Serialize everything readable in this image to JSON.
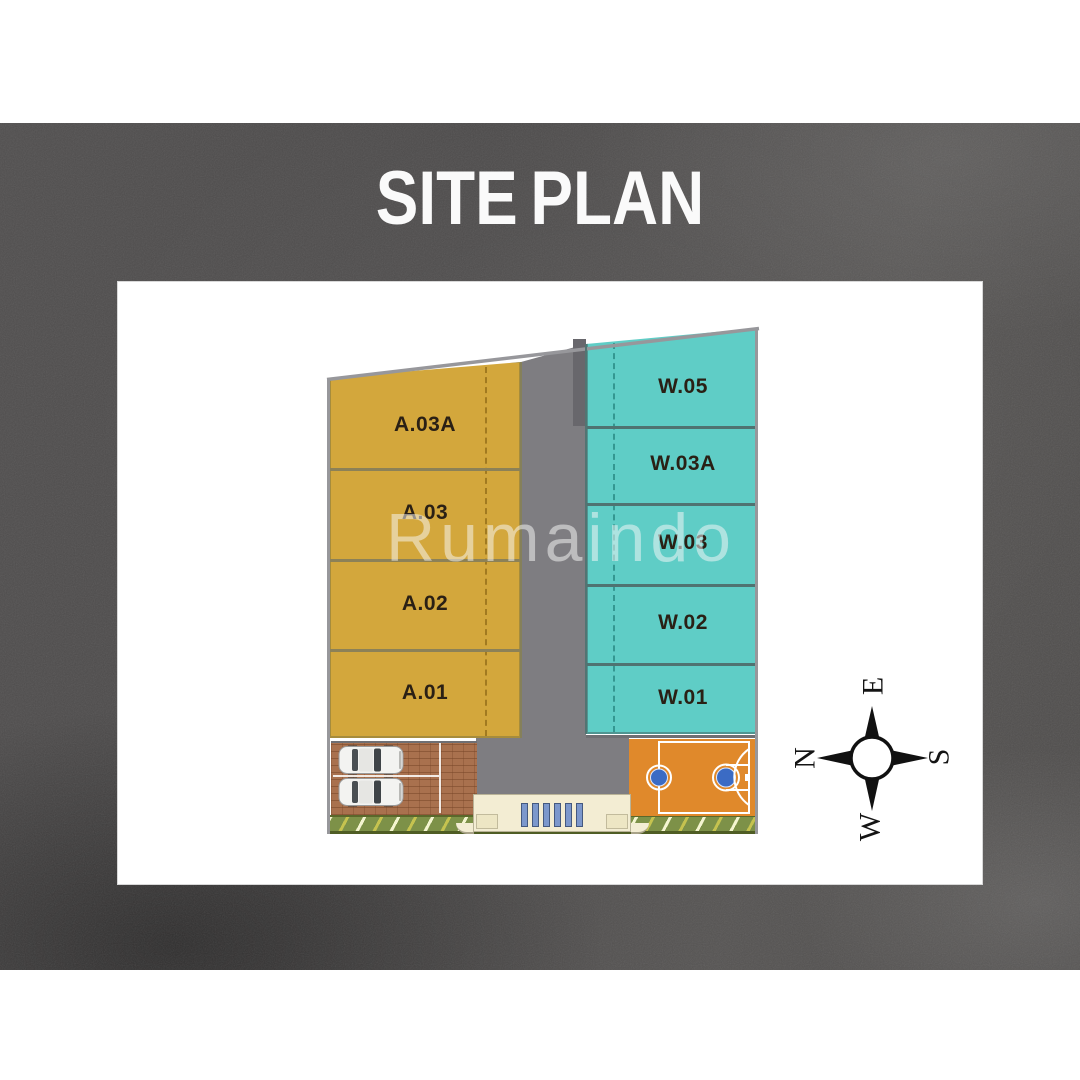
{
  "title": "SITE PLAN",
  "watermark": "Rumaindo",
  "lots": {
    "left": [
      {
        "label": "A.03A"
      },
      {
        "label": "A.03"
      },
      {
        "label": "A.02"
      },
      {
        "label": "A.01"
      }
    ],
    "right": [
      {
        "label": "W.05"
      },
      {
        "label": "W.03A"
      },
      {
        "label": "W.03"
      },
      {
        "label": "W.02"
      },
      {
        "label": "W.01"
      }
    ]
  },
  "compass": {
    "north": "N",
    "east": "E",
    "south": "S",
    "west": "W"
  },
  "colors": {
    "background_wall": "#4C4A4A",
    "panel": "#FFFFFF",
    "title_text": "#FAFAFA",
    "lot_left_fill": "#D3A73C",
    "lot_right_fill": "#5FCDC6",
    "lot_label_text": "#2A2015",
    "road": "#7E7D81",
    "brick_paving": "#A9714E",
    "basketball_court": "#E0892B",
    "court_key": "#3B6BC4",
    "gate": "#F3EDD3",
    "gate_bars": "#7C98CC",
    "green_strip": "#7D9148"
  }
}
